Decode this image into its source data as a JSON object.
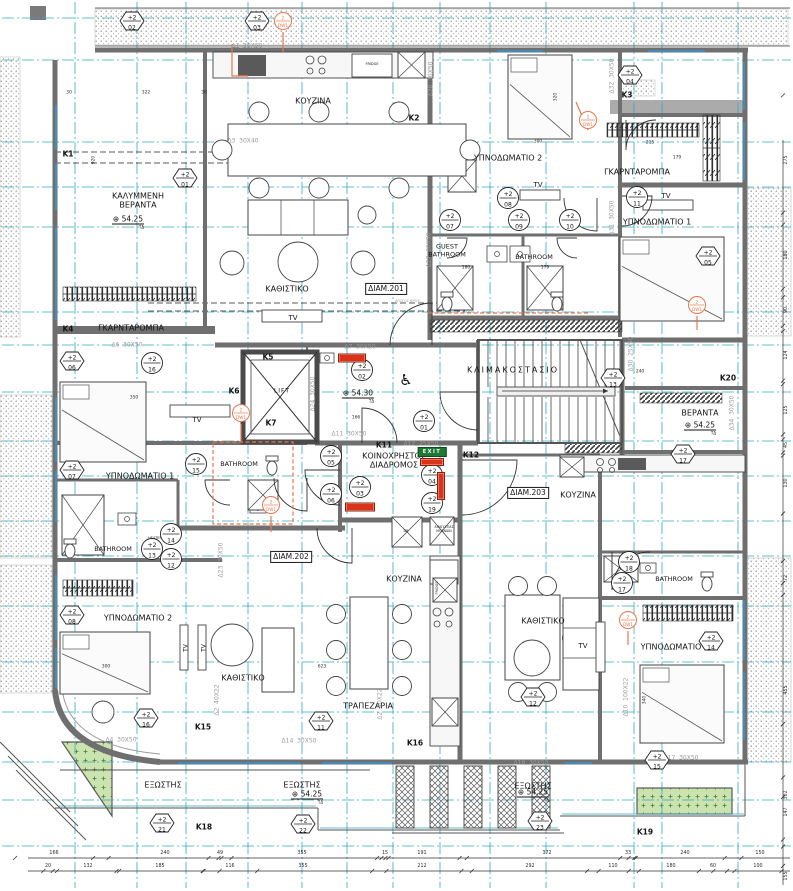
{
  "plan": {
    "marker_prefix": "+2",
    "dw_prefix": "2",
    "dw_label": "DW1",
    "level_symbol": "⊕",
    "level_sub": "ΤΔ",
    "exit_label": "EXIT",
    "colors": {
      "grid": "#35A8BE",
      "wall": "#6F6F6F",
      "accent_orange": "#E8774D",
      "accent_red": "#D9331A",
      "exit_green": "#1E7A34",
      "planter_green": "#CBE3AE",
      "beam_text": "#9B9B9B",
      "window_blue": "#3F8FC4"
    },
    "rooms": [
      {
        "t": "ΚΑΛΥΜΜΕΝΗ\nΒΕΡΑΝΤΑ",
        "x": 138,
        "y": 201
      },
      {
        "t": "ΚΟΥΖΙΝΑ",
        "x": 313,
        "y": 101
      },
      {
        "t": "ΚΑΘΙΣΤΙΚΟ",
        "x": 287,
        "y": 289
      },
      {
        "t": "ΥΠΝΟΔΩΜΑΤΙΟ 2",
        "x": 508,
        "y": 158
      },
      {
        "t": "ΓΚΑΡΝΤΑΡΟΜΠΑ",
        "x": 637,
        "y": 172
      },
      {
        "t": "ΥΠΝΟΔΩΜΑΤΙΟ 1",
        "x": 657,
        "y": 222
      },
      {
        "t": "ΓΚΑΡΝΤΑΡΟΜΠΑ",
        "x": 131,
        "y": 328
      },
      {
        "t": "ΥΠΝΟΔΩΜΑΤΙΟ 1",
        "x": 140,
        "y": 476
      },
      {
        "t": "ΚΛΙΜΑΚΟΣΤΑΣΙΟ",
        "x": 513,
        "y": 370,
        "ls": 2
      },
      {
        "t": "ΒΕΡΑΝΤΑ",
        "x": 700,
        "y": 413
      },
      {
        "t": "ΚΟΙΝΟΧΡΗΣΤΟΣ\nΔΙΑΔΡΟΜΟΣ",
        "x": 394,
        "y": 461
      },
      {
        "t": "ΚΟΥΖΙΝΑ",
        "x": 578,
        "y": 495
      },
      {
        "t": "ΥΠΝΟΔΩΜΑΤΙΟ 2",
        "x": 138,
        "y": 618
      },
      {
        "t": "ΚΑΘΙΣΤΙΚΟ",
        "x": 243,
        "y": 678
      },
      {
        "t": "ΚΟΥΖΙΝΑ",
        "x": 404,
        "y": 579
      },
      {
        "t": "ΤΡΑΠΕΖΑΡΙΑ",
        "x": 368,
        "y": 706
      },
      {
        "t": "ΚΑΘΙΣΤΙΚΟ",
        "x": 543,
        "y": 621
      },
      {
        "t": "ΥΠΝΟΔΩΜΑΤΙΟ",
        "x": 671,
        "y": 647
      },
      {
        "t": "ΕΞΩΣΤΗΣ",
        "x": 163,
        "y": 785
      },
      {
        "t": "ΕΞΩΣΤΗΣ",
        "x": 302,
        "y": 785
      },
      {
        "t": "ΕΞΩΣΤΗΣ",
        "x": 533,
        "y": 786
      },
      {
        "t": "GUEST\nBATHROOM",
        "x": 447,
        "y": 251,
        "f": 6.5
      },
      {
        "t": "BATHROOM",
        "x": 534,
        "y": 258,
        "f": 6.5
      },
      {
        "t": "BATHROOM",
        "x": 239,
        "y": 465,
        "f": 6.5
      },
      {
        "t": "BATHROOM",
        "x": 113,
        "y": 550,
        "f": 6.5
      },
      {
        "t": "BATHROOM",
        "x": 674,
        "y": 580,
        "f": 6.5
      }
    ],
    "apartment_tags": [
      {
        "t": "ΔΙΑΜ.201",
        "x": 386,
        "y": 289
      },
      {
        "t": "ΔΙΑΜ.202",
        "x": 291,
        "y": 557
      },
      {
        "t": "ΔΙΑΜ.203",
        "x": 528,
        "y": 493
      }
    ],
    "column_labels": [
      {
        "t": "K1",
        "x": 68,
        "y": 155
      },
      {
        "t": "K2",
        "x": 414,
        "y": 119
      },
      {
        "t": "K3",
        "x": 627,
        "y": 96
      },
      {
        "t": "K4",
        "x": 68,
        "y": 330
      },
      {
        "t": "K5",
        "x": 268,
        "y": 358
      },
      {
        "t": "K6",
        "x": 234,
        "y": 392
      },
      {
        "t": "K7",
        "x": 271,
        "y": 424
      },
      {
        "t": "K11",
        "x": 384,
        "y": 446
      },
      {
        "t": "K12",
        "x": 471,
        "y": 456
      },
      {
        "t": "K15",
        "x": 203,
        "y": 728
      },
      {
        "t": "K16",
        "x": 415,
        "y": 744
      },
      {
        "t": "K18",
        "x": 204,
        "y": 828
      },
      {
        "t": "K19",
        "x": 645,
        "y": 833
      },
      {
        "t": "K20",
        "x": 728,
        "y": 379
      }
    ],
    "beam_labels": [
      {
        "t": "Δ1  30X50",
        "x": 247,
        "y": 46
      },
      {
        "t": "Δ3  30X40",
        "x": 243,
        "y": 141
      },
      {
        "t": "Δ6  30X50",
        "x": 127,
        "y": 345
      },
      {
        "t": "Δ7  30X50",
        "x": 360,
        "y": 347
      },
      {
        "t": "Δ11  30X50",
        "x": 349,
        "y": 434
      },
      {
        "t": "Δ12  25X50",
        "x": 421,
        "y": 444
      },
      {
        "t": "Δ16  30X50",
        "x": 531,
        "y": 763
      },
      {
        "t": "Δ17  30X50",
        "x": 681,
        "y": 758
      },
      {
        "t": "Δ4  30X50",
        "x": 121,
        "y": 740
      },
      {
        "t": "Δ14  30X50",
        "x": 299,
        "y": 741
      },
      {
        "t": "Δ28  30X50",
        "x": 431,
        "y": 79,
        "r": -90
      },
      {
        "t": "Δ27  30X50",
        "x": 429,
        "y": 250,
        "r": -90
      },
      {
        "t": "Δ31  30X50",
        "x": 612,
        "y": 218,
        "r": -90
      },
      {
        "t": "Δ32  30X50",
        "x": 612,
        "y": 76,
        "r": -90
      },
      {
        "t": "Δ23  30X50",
        "x": 221,
        "y": 560,
        "r": -90
      },
      {
        "t": "Δ30  25X50",
        "x": 631,
        "y": 354,
        "r": -90
      },
      {
        "t": "Δ34  30X50",
        "x": 732,
        "y": 413,
        "r": -90
      },
      {
        "t": "Δ2  40X22",
        "x": 380,
        "y": 704,
        "r": -90
      },
      {
        "t": "Δ2  40X22",
        "x": 217,
        "y": 700,
        "r": -90
      },
      {
        "t": "Δ24  30X50",
        "x": 313,
        "y": 394,
        "r": -90
      },
      {
        "t": "Δ10  100X22",
        "x": 626,
        "y": 697,
        "r": -90
      }
    ],
    "circle_markers": [
      {
        "n": "01",
        "x": 424,
        "y": 423
      },
      {
        "n": "02",
        "x": 362,
        "y": 372
      },
      {
        "n": "03",
        "x": 360,
        "y": 489
      },
      {
        "n": "04",
        "x": 432,
        "y": 477
      },
      {
        "n": "19",
        "x": 432,
        "y": 505
      },
      {
        "n": "05",
        "x": 331,
        "y": 458
      },
      {
        "n": "06",
        "x": 331,
        "y": 496
      },
      {
        "n": "07",
        "x": 450,
        "y": 222
      },
      {
        "n": "08",
        "x": 508,
        "y": 200
      },
      {
        "n": "09",
        "x": 519,
        "y": 222
      },
      {
        "n": "10",
        "x": 570,
        "y": 222
      },
      {
        "n": "11",
        "x": 637,
        "y": 199
      },
      {
        "n": "12",
        "x": 171,
        "y": 561
      },
      {
        "n": "13",
        "x": 152,
        "y": 551
      },
      {
        "n": "14",
        "x": 171,
        "y": 536
      },
      {
        "n": "15",
        "x": 196,
        "y": 466
      },
      {
        "n": "16",
        "x": 152,
        "y": 365
      },
      {
        "n": "17",
        "x": 622,
        "y": 585
      },
      {
        "n": "18",
        "x": 629,
        "y": 564
      }
    ],
    "hex_markers": [
      {
        "n": "02",
        "x": 132,
        "y": 23
      },
      {
        "n": "03",
        "x": 257,
        "y": 23
      },
      {
        "n": "01",
        "x": 185,
        "y": 180
      },
      {
        "n": "04",
        "x": 630,
        "y": 77
      },
      {
        "n": "05",
        "x": 708,
        "y": 258
      },
      {
        "n": "06",
        "x": 72,
        "y": 363
      },
      {
        "n": "07",
        "x": 72,
        "y": 472
      },
      {
        "n": "08",
        "x": 72,
        "y": 617
      },
      {
        "n": "16",
        "x": 146,
        "y": 720
      },
      {
        "n": "11",
        "x": 321,
        "y": 723
      },
      {
        "n": "12",
        "x": 533,
        "y": 699
      },
      {
        "n": "14",
        "x": 711,
        "y": 643
      },
      {
        "n": "15",
        "x": 657,
        "y": 762
      },
      {
        "n": "13",
        "x": 613,
        "y": 380
      },
      {
        "n": "17",
        "x": 683,
        "y": 456
      },
      {
        "n": "21",
        "x": 162,
        "y": 825
      },
      {
        "n": "22",
        "x": 303,
        "y": 826
      },
      {
        "n": "23",
        "x": 540,
        "y": 823
      }
    ],
    "dw_markers": [
      {
        "x": 283,
        "y": 23
      },
      {
        "x": 588,
        "y": 122
      },
      {
        "x": 697,
        "y": 307
      },
      {
        "x": 241,
        "y": 415
      },
      {
        "x": 271,
        "y": 507
      },
      {
        "x": 628,
        "y": 622
      }
    ],
    "level_markers": [
      {
        "t": "54.25",
        "x": 128,
        "y": 222
      },
      {
        "t": "54.30",
        "x": 358,
        "y": 396
      },
      {
        "t": "54.25",
        "x": 700,
        "y": 428
      },
      {
        "t": "54.25",
        "x": 307,
        "y": 797
      },
      {
        "t": "54.25",
        "x": 533,
        "y": 795
      }
    ],
    "misc_labels": [
      {
        "t": "TV",
        "x": 293,
        "y": 318,
        "f": 7
      },
      {
        "t": "TV",
        "x": 197,
        "y": 420,
        "f": 7
      },
      {
        "t": "TV",
        "x": 538,
        "y": 185,
        "f": 7
      },
      {
        "t": "TV",
        "x": 666,
        "y": 196,
        "f": 7
      },
      {
        "t": "TV",
        "x": 583,
        "y": 646,
        "f": 7
      },
      {
        "t": "TV",
        "x": 186,
        "y": 648,
        "f": 6,
        "r": -90
      },
      {
        "t": "TV",
        "x": 204,
        "y": 648,
        "f": 6,
        "r": -90
      },
      {
        "t": "FRIDGE",
        "x": 372,
        "y": 64,
        "f": 3.5
      },
      {
        "t": "FRIDGE",
        "x": 437,
        "y": 588,
        "f": 3.5,
        "r": -90
      },
      {
        "t": "HEATER",
        "x": 155,
        "y": 538,
        "f": 3.5
      },
      {
        "t": "LIFT",
        "x": 282,
        "y": 391,
        "f": 6,
        "ls": 1
      },
      {
        "t": "DB",
        "x": 406,
        "y": 531,
        "f": 3.5
      },
      {
        "t": "ΑΠΑΓΩΓΕΑΣ\nΜΠΑΝΙΩΝ",
        "x": 444,
        "y": 530,
        "f": 3.2
      },
      {
        "t": "ΑΓΩΓΟΣ ΒΡΟΧ.",
        "x": 408,
        "y": 301,
        "f": 3.5,
        "c": "gray"
      }
    ],
    "red_tags": [
      {
        "x": 352,
        "y": 358,
        "w": 26,
        "h": 7
      },
      {
        "x": 360,
        "y": 507,
        "w": 28,
        "h": 7
      },
      {
        "x": 432,
        "y": 462,
        "w": 22,
        "h": 6
      },
      {
        "x": 441,
        "y": 486,
        "w": 6,
        "h": 26
      }
    ],
    "exit_sign": {
      "x": 432,
      "y": 452
    },
    "wheelchair": {
      "x": 406,
      "y": 380,
      "t": "♿"
    },
    "dims": {
      "bottom_row1": [
        {
          "v": "166",
          "x": 54
        },
        {
          "v": "240",
          "x": 165
        },
        {
          "v": "49",
          "x": 220
        },
        {
          "v": "355",
          "x": 302
        },
        {
          "v": "15",
          "x": 385
        },
        {
          "v": "191",
          "x": 422
        },
        {
          "v": "372",
          "x": 547
        },
        {
          "v": "33",
          "x": 628
        },
        {
          "v": "240",
          "x": 685
        },
        {
          "v": "150",
          "x": 760
        }
      ],
      "bottom_row2": [
        {
          "v": "20",
          "x": 48
        },
        {
          "v": "132",
          "x": 88
        },
        {
          "v": "185",
          "x": 160
        },
        {
          "v": "116",
          "x": 230
        },
        {
          "v": "355",
          "x": 303
        },
        {
          "v": "212",
          "x": 422
        },
        {
          "v": "292",
          "x": 530
        },
        {
          "v": "110",
          "x": 613
        },
        {
          "v": "180",
          "x": 671
        },
        {
          "v": "60",
          "x": 713
        },
        {
          "v": "100",
          "x": 758
        }
      ],
      "right_col": [
        {
          "v": "275",
          "y": 160
        },
        {
          "v": "180",
          "y": 255
        },
        {
          "v": "90",
          "y": 310
        },
        {
          "v": "124",
          "y": 355
        },
        {
          "v": "125",
          "y": 410
        },
        {
          "v": "45",
          "y": 445
        },
        {
          "v": "130",
          "y": 483
        },
        {
          "v": "72",
          "y": 578
        },
        {
          "v": "455",
          "y": 690
        },
        {
          "v": "302",
          "y": 795
        },
        {
          "v": "147",
          "y": 812
        },
        {
          "v": "155",
          "y": 876
        }
      ],
      "interior": [
        {
          "v": "322",
          "x": 146,
          "y": 93
        },
        {
          "v": "30",
          "x": 69,
          "y": 93
        },
        {
          "v": "38",
          "x": 204,
          "y": 93
        },
        {
          "v": "300",
          "x": 538,
          "y": 142
        },
        {
          "v": "215",
          "x": 650,
          "y": 143
        },
        {
          "v": "179",
          "x": 677,
          "y": 158
        },
        {
          "v": "350",
          "x": 134,
          "y": 398
        },
        {
          "v": "300",
          "x": 106,
          "y": 667
        },
        {
          "v": "623",
          "x": 322,
          "y": 667
        },
        {
          "v": "240",
          "x": 640,
          "y": 372
        },
        {
          "v": "180",
          "x": 466,
          "y": 268
        },
        {
          "v": "179",
          "x": 545,
          "y": 268
        },
        {
          "v": "166",
          "x": 356,
          "y": 418
        },
        {
          "v": "920",
          "x": 94,
          "y": 160,
          "r": -90
        },
        {
          "v": "320",
          "x": 556,
          "y": 97,
          "r": -90
        },
        {
          "v": "310",
          "x": 703,
          "y": 253,
          "r": -90
        },
        {
          "v": "340",
          "x": 645,
          "y": 700,
          "r": -90
        }
      ]
    }
  }
}
